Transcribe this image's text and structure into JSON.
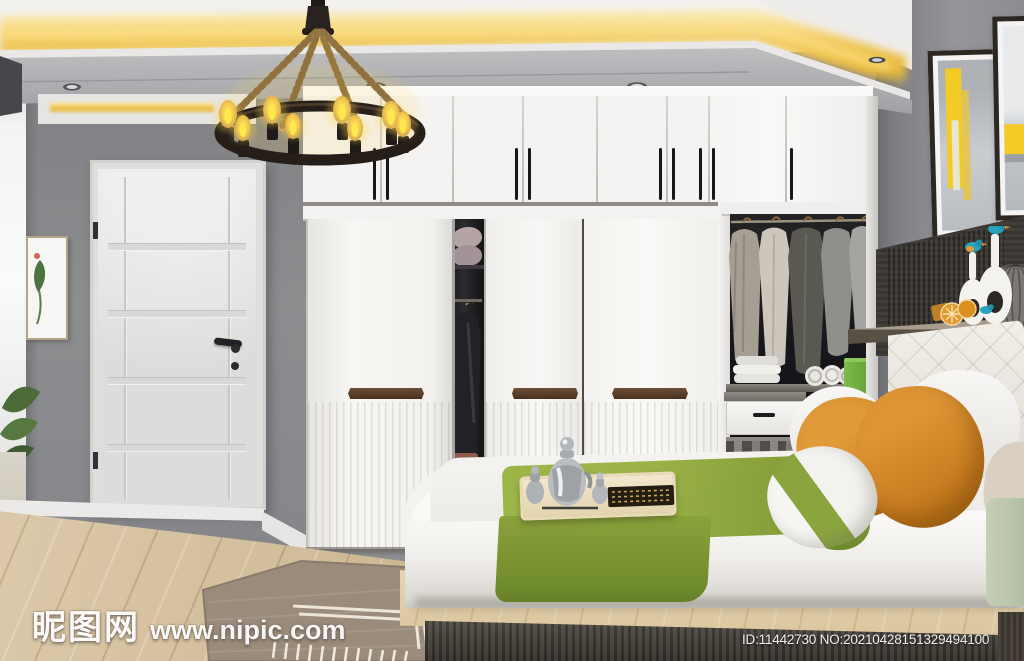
{
  "image": {
    "type": "interior-3d-render",
    "description": "Modern bedroom render: white wardrobe with sliding doors and open closet with hanging clothes, rustic rope chandelier with Edison bulbs, white panel door, grey walls with warm cove lighting, platform bed with green runner, breakfast tray and orange pillows, abstract yellow wall art and shelf decor",
    "width_px": 1024,
    "height_px": 661
  },
  "watermark": {
    "logo_text": "昵图网",
    "site_text": "www.nipic.com"
  },
  "id_bar": {
    "text": "ID:11442730 NO:20210428151329494100"
  },
  "palette": {
    "cove_light": "#EFC24A",
    "bulb_glow": "#F6D73C",
    "wall_grey": "#85878A",
    "wardrobe_white": "#F6F5F3",
    "closet_interior": "#1B1B1E",
    "handle_walnut": "#5A4030",
    "runner_green": "#8FA93D",
    "pillow_orange": "#D68A2B",
    "bin_green": "#6FAE3E",
    "bird_teal": "#2BA4BD",
    "floor_wood": "#D5C2A2",
    "platform_wood": "#DECB9F",
    "footboard_dark": "#45403A",
    "headboard_panel": "#3E3A35"
  },
  "scene": {
    "ceiling": [
      "yellow-cove-strip",
      "grey-soffit",
      "recessed-downlights"
    ],
    "left_side": [
      "adjacent-room-glimpse",
      "small-botanical-frame",
      "green-plant",
      "white-panel-door",
      "black-door-handle"
    ],
    "wardrobe": [
      "white-top-cabinets",
      "black-bar-handles",
      "three-sliding-doors",
      "walnut-door-handles",
      "open-gap-with-pillows",
      "hanging-dark-garment",
      "open-closet",
      "hanging-coats",
      "folded-towels",
      "rolled-towels",
      "white-drawer",
      "green-bin",
      "slatted-rack"
    ],
    "bed": [
      "tufted-white-headboard",
      "white-duvet",
      "olive-green-runner",
      "wooden-breakfast-tray",
      "silver-teapot-set",
      "orange-pillows",
      "green-stripe-pillow",
      "wood-platform",
      "dark-footboard"
    ],
    "right_wall": [
      "abstract-yellow-art-1",
      "abstract-yellow-art-2",
      "dark-wood-panel",
      "display-shelf",
      "white-ring-vases",
      "kingfisher-bird-figurines",
      "orange-fruit-decor",
      "ribbed-sphere-vase"
    ],
    "floor": [
      "oak-plank-floor",
      "taupe-area-rug-with-white-pattern"
    ]
  }
}
